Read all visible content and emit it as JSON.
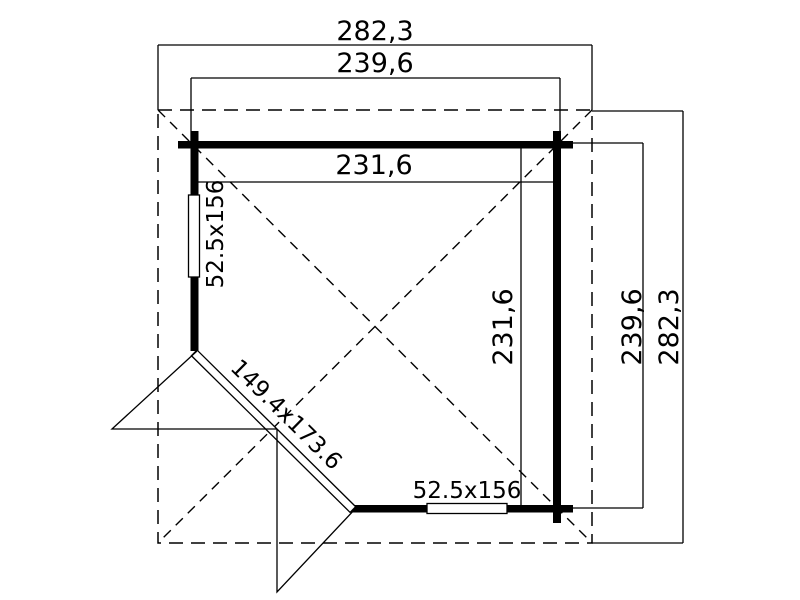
{
  "drawing": {
    "type": "floor-plan",
    "colors": {
      "line": "#000000",
      "background": "#ffffff"
    },
    "dimensions": {
      "top_overall_width": "282,3",
      "top_outer_width": "239,6",
      "top_inner_width": "231,6",
      "right_inner_depth": "231,6",
      "right_outer_depth": "239,6",
      "right_overall_depth": "282,3"
    },
    "openings": {
      "left_window_size": "52.5x156",
      "bottom_window_size": "52.5x156",
      "corner_door_size": "149.4x173.6"
    }
  }
}
